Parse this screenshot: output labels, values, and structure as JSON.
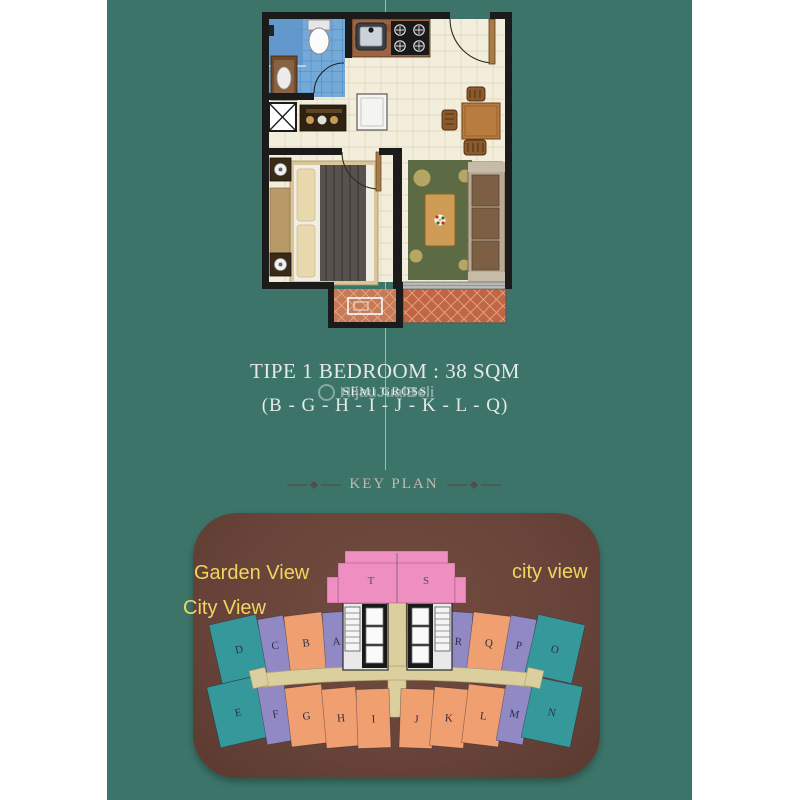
{
  "colors": {
    "teal_bg": "#3c7469",
    "panel_brown": "#69443a",
    "unit_teal": "#35999c",
    "unit_lavender": "#9089c4",
    "unit_orange": "#f0a070",
    "unit_pink": "#ef8fc1",
    "corridor_tan": "#dccf9e",
    "label_yellow": "#f2d55e",
    "heading_gray": "#c6bab0",
    "title_white": "#e4e8e6"
  },
  "floorplan_section": {
    "title": "TIPE 1 BEDROOM : 38 SQM",
    "subtitle": "SEMI GROSS",
    "units_list": "(B - G - H - I - J - K - L - Q)"
  },
  "watermark": {
    "text": "HijauJualBeli"
  },
  "keyplan": {
    "heading": "KEY PLAN",
    "view_labels": [
      {
        "text": "Garden View"
      },
      {
        "text": "city view"
      },
      {
        "text": "City View"
      }
    ],
    "tower_units": [
      {
        "letter": "T",
        "x": 178,
        "y": 71
      },
      {
        "letter": "S",
        "x": 233,
        "y": 71
      }
    ],
    "wing_units_upper": [
      {
        "letter": "D",
        "color": "teal",
        "x": 22,
        "y": 106,
        "w": 48,
        "h": 60,
        "rot": -13
      },
      {
        "letter": "C",
        "color": "lavender",
        "x": 69,
        "y": 104,
        "w": 26,
        "h": 56,
        "rot": -10
      },
      {
        "letter": "B",
        "color": "orange",
        "x": 94,
        "y": 101,
        "w": 38,
        "h": 57,
        "rot": -7
      },
      {
        "letter": "A",
        "color": "lavender",
        "x": 131,
        "y": 99,
        "w": 25,
        "h": 58,
        "rot": -4
      },
      {
        "letter": "R",
        "color": "lavender",
        "x": 253,
        "y": 99,
        "w": 25,
        "h": 58,
        "rot": 4
      },
      {
        "letter": "Q",
        "color": "orange",
        "x": 277,
        "y": 101,
        "w": 38,
        "h": 57,
        "rot": 7
      },
      {
        "letter": "P",
        "color": "lavender",
        "x": 313,
        "y": 104,
        "w": 26,
        "h": 56,
        "rot": 10
      },
      {
        "letter": "O",
        "color": "teal",
        "x": 338,
        "y": 106,
        "w": 48,
        "h": 60,
        "rot": 13
      }
    ],
    "wing_units_lower": [
      {
        "letter": "E",
        "color": "teal",
        "x": 20,
        "y": 168,
        "w": 50,
        "h": 62,
        "rot": -13
      },
      {
        "letter": "F",
        "color": "lavender",
        "x": 69,
        "y": 171,
        "w": 27,
        "h": 59,
        "rot": -10
      },
      {
        "letter": "G",
        "color": "orange",
        "x": 95,
        "y": 173,
        "w": 37,
        "h": 59,
        "rot": -7
      },
      {
        "letter": "H",
        "color": "orange",
        "x": 131,
        "y": 175,
        "w": 34,
        "h": 59,
        "rot": -5
      },
      {
        "letter": "I",
        "color": "orange",
        "x": 164,
        "y": 176,
        "w": 33,
        "h": 59,
        "rot": -2
      },
      {
        "letter": "J",
        "color": "orange",
        "x": 207,
        "y": 176,
        "w": 33,
        "h": 59,
        "rot": 2
      },
      {
        "letter": "K",
        "color": "orange",
        "x": 239,
        "y": 175,
        "w": 34,
        "h": 59,
        "rot": 5
      },
      {
        "letter": "L",
        "color": "orange",
        "x": 272,
        "y": 173,
        "w": 37,
        "h": 59,
        "rot": 7
      },
      {
        "letter": "M",
        "color": "lavender",
        "x": 308,
        "y": 171,
        "w": 27,
        "h": 59,
        "rot": 10
      },
      {
        "letter": "N",
        "color": "teal",
        "x": 334,
        "y": 168,
        "w": 50,
        "h": 62,
        "rot": 12
      }
    ]
  }
}
